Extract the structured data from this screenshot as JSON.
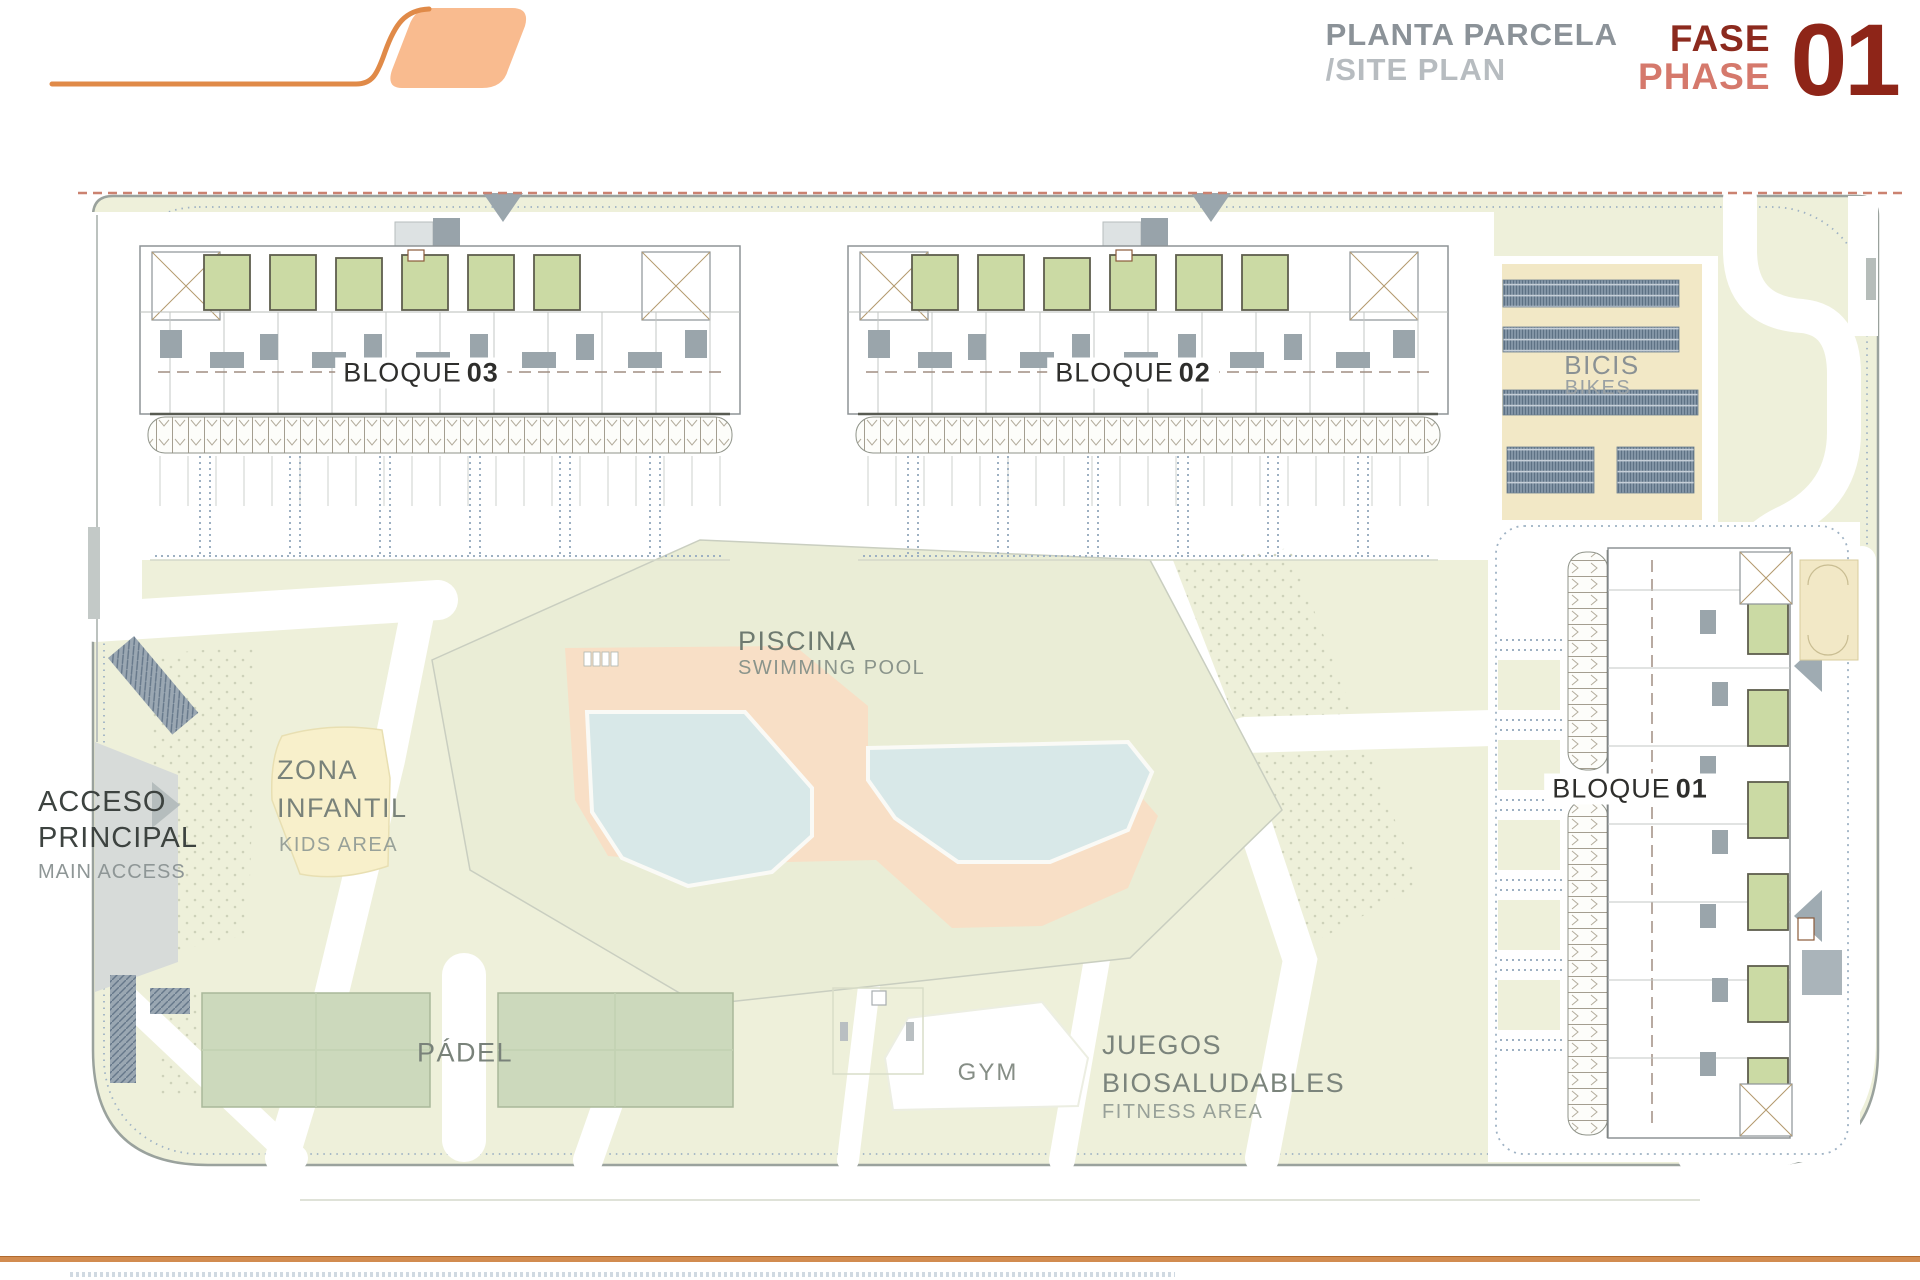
{
  "header": {
    "title_es": "PLANTA PARCELA",
    "title_en": "/SITE PLAN",
    "phase_es": "FASE",
    "phase_en": "PHASE",
    "phase_number": "01"
  },
  "plan": {
    "blocks": [
      {
        "word": "BLOQUE",
        "number": "03"
      },
      {
        "word": "BLOQUE",
        "number": "02"
      },
      {
        "word": "BLOQUE",
        "number": "01"
      }
    ],
    "bikes": {
      "es": "BICIS",
      "en": "BIKES"
    },
    "pool": {
      "es": "PISCINA",
      "en": "SWIMMING POOL"
    },
    "kids": {
      "es1": "ZONA",
      "es2": "INFANTIL",
      "en": "KIDS AREA"
    },
    "access": {
      "es1": "ACCESO",
      "es2": "PRINCIPAL",
      "en": "MAIN ACCESS"
    },
    "padel": {
      "label": "PÁDEL"
    },
    "gym": {
      "label": "GYM"
    },
    "fitness": {
      "es1": "JUEGOS",
      "es2": "BIOSALUDABLES",
      "en": "FITNESS AREA"
    }
  },
  "colors": {
    "accent_orange": "#e08a48",
    "logo_fill": "#f9bb8f",
    "header_gray": "#8b9298",
    "header_gray_light": "#b7bcc0",
    "phase_red_dark": "#8c2a1e",
    "phase_red_light": "#d5796c",
    "phase_number_red": "#8e2518",
    "plan_green": "#eef0da",
    "court_green": "#ccd9bc",
    "patio_green": "#cbdaa4",
    "bike_rack_blue": "#8496a7",
    "sand_beige": "#f2e8c6",
    "kids_yellow": "#f8f0cb",
    "pool_deck_salmon": "#f8dfc6",
    "pool_water_blue": "#d8e8e8",
    "road_gray": "#d7dbd9",
    "boundary_dash_red": "#cb8270",
    "footer_orange": "#d28c50"
  }
}
